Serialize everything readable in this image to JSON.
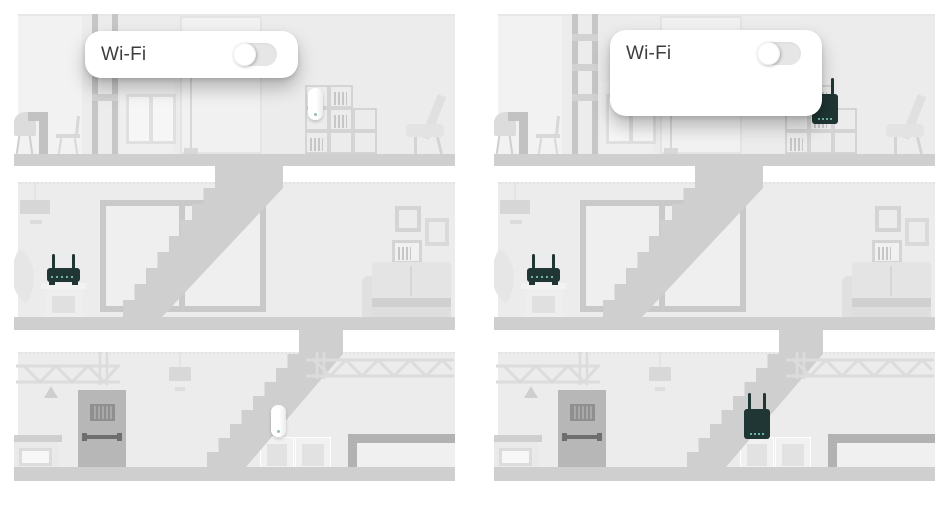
{
  "left_panel": {
    "wifi_card": {
      "label": "Wi-Fi",
      "toggle_state": "off"
    },
    "devices": {
      "top_floor": "white-range-extender-on-bookshelf",
      "middle_floor": "wifi-router-on-cabinet",
      "basement": "white-range-extender-on-boxes"
    }
  },
  "right_panel": {
    "wifi_card": {
      "label": "Wi-Fi",
      "toggle_state": "off"
    },
    "devices": {
      "top_floor": "dark-range-extender-on-bookshelf",
      "middle_floor": "wifi-router-on-cabinet",
      "basement": "dark-range-extender-on-boxes"
    }
  },
  "colors": {
    "background": "#ffffff",
    "wall": "#ececec",
    "floor_slab": "#cfcfcf",
    "card_background": "#ffffff",
    "toggle_track": "#e6e6e6",
    "toggle_knob": "#ffffff",
    "label_text": "#3d3d3d",
    "device_dark": "#1f3634",
    "device_led": "#6fb3a4",
    "device_white": "#fbfbfb"
  }
}
